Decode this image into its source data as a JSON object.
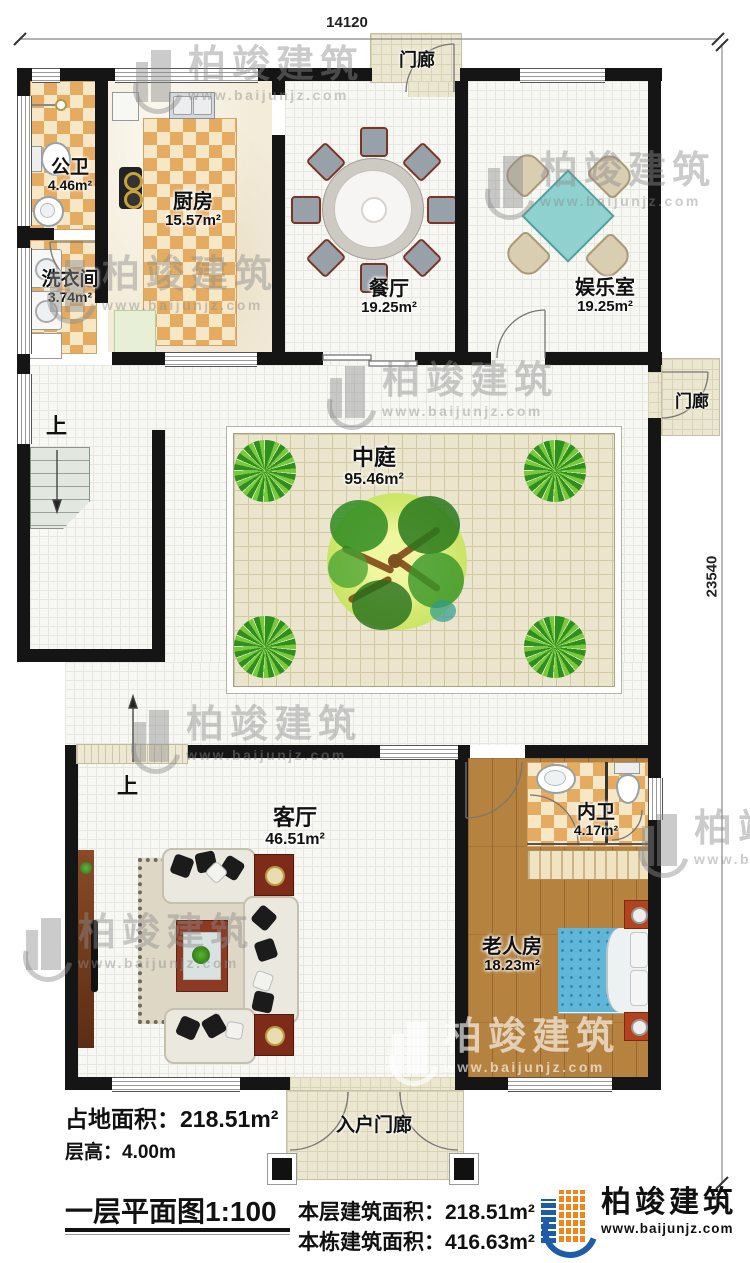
{
  "dims": {
    "width": "14120",
    "height": "23540"
  },
  "rooms": {
    "gongwei": {
      "name": "公卫",
      "area": "4.46m²"
    },
    "chufang": {
      "name": "厨房",
      "area": "15.57m²"
    },
    "canting": {
      "name": "餐厅",
      "area": "19.25m²"
    },
    "yuleshi": {
      "name": "娱乐室",
      "area": "19.25m²"
    },
    "xiyijian": {
      "name": "洗衣间",
      "area": "3.74m²"
    },
    "zhongting": {
      "name": "中庭",
      "area": "95.46m²"
    },
    "keting": {
      "name": "客厅",
      "area": "46.51m²"
    },
    "neiwei": {
      "name": "内卫",
      "area": "4.17m²"
    },
    "laorenfang": {
      "name": "老人房",
      "area": "18.23m²"
    }
  },
  "porches": {
    "top": "门廊",
    "side": "门廊",
    "entry": "入户门廊"
  },
  "stairs": {
    "up": "上"
  },
  "info": {
    "land_area_label": "占地面积：",
    "land_area_value": "218.51m²",
    "floor_height_label": "层高：",
    "floor_height_value": "4.00m",
    "plan_title": "一层平面图1:100",
    "floor_area_label": "本层建筑面积：",
    "floor_area_value": "218.51m²",
    "total_area_label": "本栋建筑面积：",
    "total_area_value": "416.63m²"
  },
  "brand": {
    "name": "柏竣建筑",
    "url": "www.baijunjz.com"
  },
  "watermark": {
    "name": "柏竣建筑",
    "url": "www.baijunjz.com"
  },
  "colors": {
    "wall": "#151515",
    "tile_orange": "#e5ab61",
    "wood": "#b5833f",
    "bed_blue": "#5fb6d8",
    "table_teal": "#8ed1cf",
    "courtyard": "#ebe5cd",
    "logo_blue": "#1d5ca6",
    "logo_orange": "#f08519"
  }
}
